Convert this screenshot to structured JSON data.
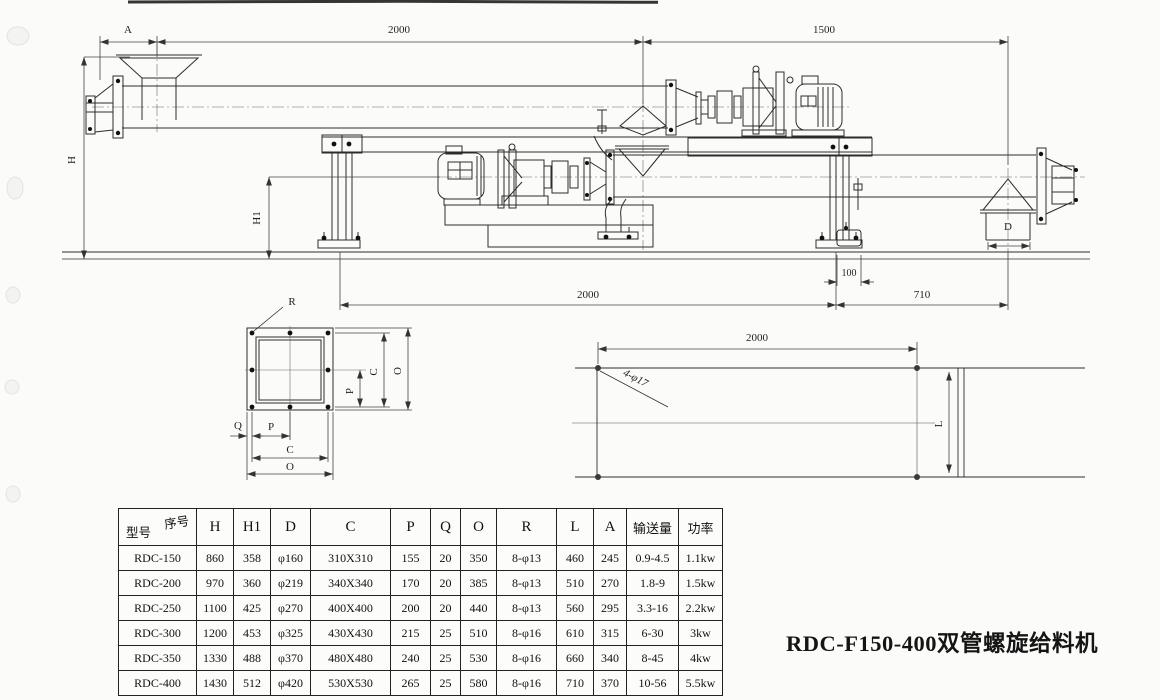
{
  "caption": "RDC-F150-400双管螺旋给料机",
  "drawing": {
    "dims": {
      "a": "A",
      "span_2000_top": "2000",
      "span_1500": "1500",
      "h": "H",
      "h1": "H1",
      "offset_100": "100",
      "span_2000_bottom": "2000",
      "span_710": "710",
      "d": "D"
    },
    "flange_detail": {
      "r": "R",
      "p_right": "P",
      "c_right": "C",
      "o_right": "O",
      "q": "Q",
      "p_bottom": "P",
      "c_bottom": "C",
      "o_bottom": "O"
    },
    "plate_detail": {
      "span_2000": "2000",
      "holes": "4-φ17",
      "l": "L"
    }
  },
  "table": {
    "header": {
      "model": "型号",
      "serial": "序号",
      "cols": [
        "H",
        "H1",
        "D",
        "C",
        "P",
        "Q",
        "O",
        "R",
        "L",
        "A",
        "输送量",
        "功率"
      ]
    },
    "rows": [
      {
        "model": "RDC-150",
        "values": [
          "860",
          "358",
          "φ160",
          "310X310",
          "155",
          "20",
          "350",
          "8-φ13",
          "460",
          "245",
          "0.9-4.5",
          "1.1kw"
        ]
      },
      {
        "model": "RDC-200",
        "values": [
          "970",
          "360",
          "φ219",
          "340X340",
          "170",
          "20",
          "385",
          "8-φ13",
          "510",
          "270",
          "1.8-9",
          "1.5kw"
        ]
      },
      {
        "model": "RDC-250",
        "values": [
          "1100",
          "425",
          "φ270",
          "400X400",
          "200",
          "20",
          "440",
          "8-φ13",
          "560",
          "295",
          "3.3-16",
          "2.2kw"
        ]
      },
      {
        "model": "RDC-300",
        "values": [
          "1200",
          "453",
          "φ325",
          "430X430",
          "215",
          "25",
          "510",
          "8-φ16",
          "610",
          "315",
          "6-30",
          "3kw"
        ]
      },
      {
        "model": "RDC-350",
        "values": [
          "1330",
          "488",
          "φ370",
          "480X480",
          "240",
          "25",
          "530",
          "8-φ16",
          "660",
          "340",
          "8-45",
          "4kw"
        ]
      },
      {
        "model": "RDC-400",
        "values": [
          "1430",
          "512",
          "φ420",
          "530X530",
          "265",
          "25",
          "580",
          "8-φ16",
          "710",
          "370",
          "10-56",
          "5.5kw"
        ]
      }
    ]
  }
}
